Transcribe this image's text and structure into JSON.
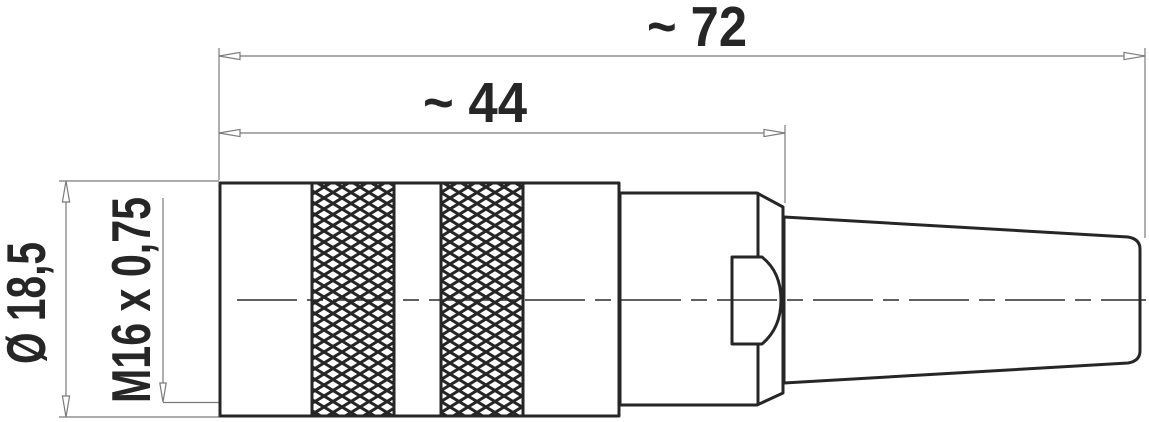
{
  "figure": {
    "type": "technical-drawing",
    "labels": {
      "overall_length": "~ 72",
      "body_length": "~ 44",
      "diameter": "Ø 18,5",
      "thread": "M16 x 0,75"
    },
    "colors": {
      "outline": "#262626",
      "dimension": "#7a7a7a",
      "centerline": "#2b2b2b",
      "background": "#ffffff"
    }
  }
}
